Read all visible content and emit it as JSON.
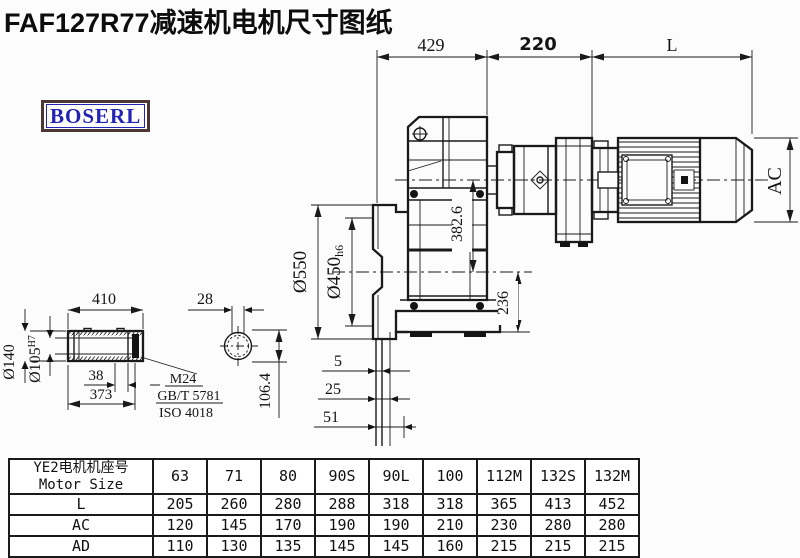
{
  "title": "FAF127R77减速机电机尺寸图纸",
  "brand": {
    "label": "BOSERL"
  },
  "colors": {
    "line": "#1a1a1a",
    "brand_text": "#2323b4",
    "brand_border": "#4b3832",
    "background": "#fcfcfc"
  },
  "dimensions": {
    "top_width": "429",
    "adapter_width": "220",
    "motor_length": "L",
    "motor_diameter": "AC",
    "center_height": "382.6",
    "axis_to_base": "236",
    "flange_od": "Ø550",
    "flange_spigot": "Ø450",
    "flange_spigot_tol": "h6",
    "shaft_length": "410",
    "shaft_end_width": "28",
    "hub_od": "Ø140",
    "bore": "Ø105",
    "bore_tol": "H7",
    "end_step": "38",
    "bore_depth": "373",
    "foot_gap_small": "5",
    "foot_gap_mid": "25",
    "foot_gap_large": "51",
    "shaft_offset": "106.4"
  },
  "note": {
    "line1": "M24",
    "line2": "GB/T 5781",
    "line3": "ISO 4018"
  },
  "table": {
    "header": {
      "line1": "YE2电机机座号",
      "line2": "Motor Size"
    },
    "columns": [
      "63",
      "71",
      "80",
      "90S",
      "90L",
      "100",
      "112M",
      "132S",
      "132M"
    ],
    "rows": [
      {
        "label": "L",
        "values": [
          "205",
          "260",
          "280",
          "288",
          "318",
          "318",
          "365",
          "413",
          "452"
        ]
      },
      {
        "label": "AC",
        "values": [
          "120",
          "145",
          "170",
          "190",
          "190",
          "210",
          "230",
          "280",
          "280"
        ]
      },
      {
        "label": "AD",
        "values": [
          "110",
          "130",
          "135",
          "145",
          "145",
          "160",
          "215",
          "215",
          "215"
        ]
      }
    ]
  }
}
